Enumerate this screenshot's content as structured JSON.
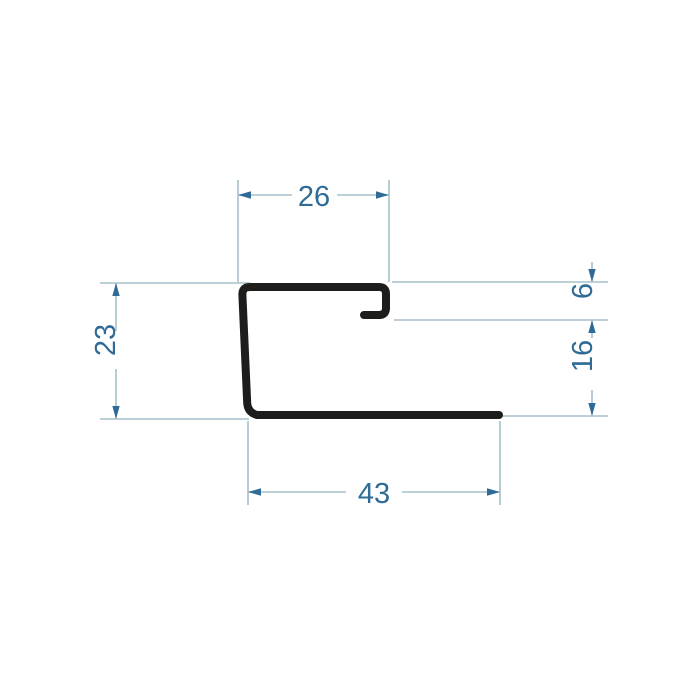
{
  "drawing": {
    "type": "technical-profile-cross-section",
    "description": "Cross-section of a J-shaped metal trim profile with dimension lines",
    "dims": {
      "top_width": "26",
      "lip_height": "6",
      "right_height": "16",
      "left_height": "23",
      "bottom_width": "43"
    },
    "colors": {
      "profile": "#1d1d1b",
      "thin_lines": "#a7bfca",
      "accent": "#2e6b96",
      "background": "#ffffff"
    }
  }
}
